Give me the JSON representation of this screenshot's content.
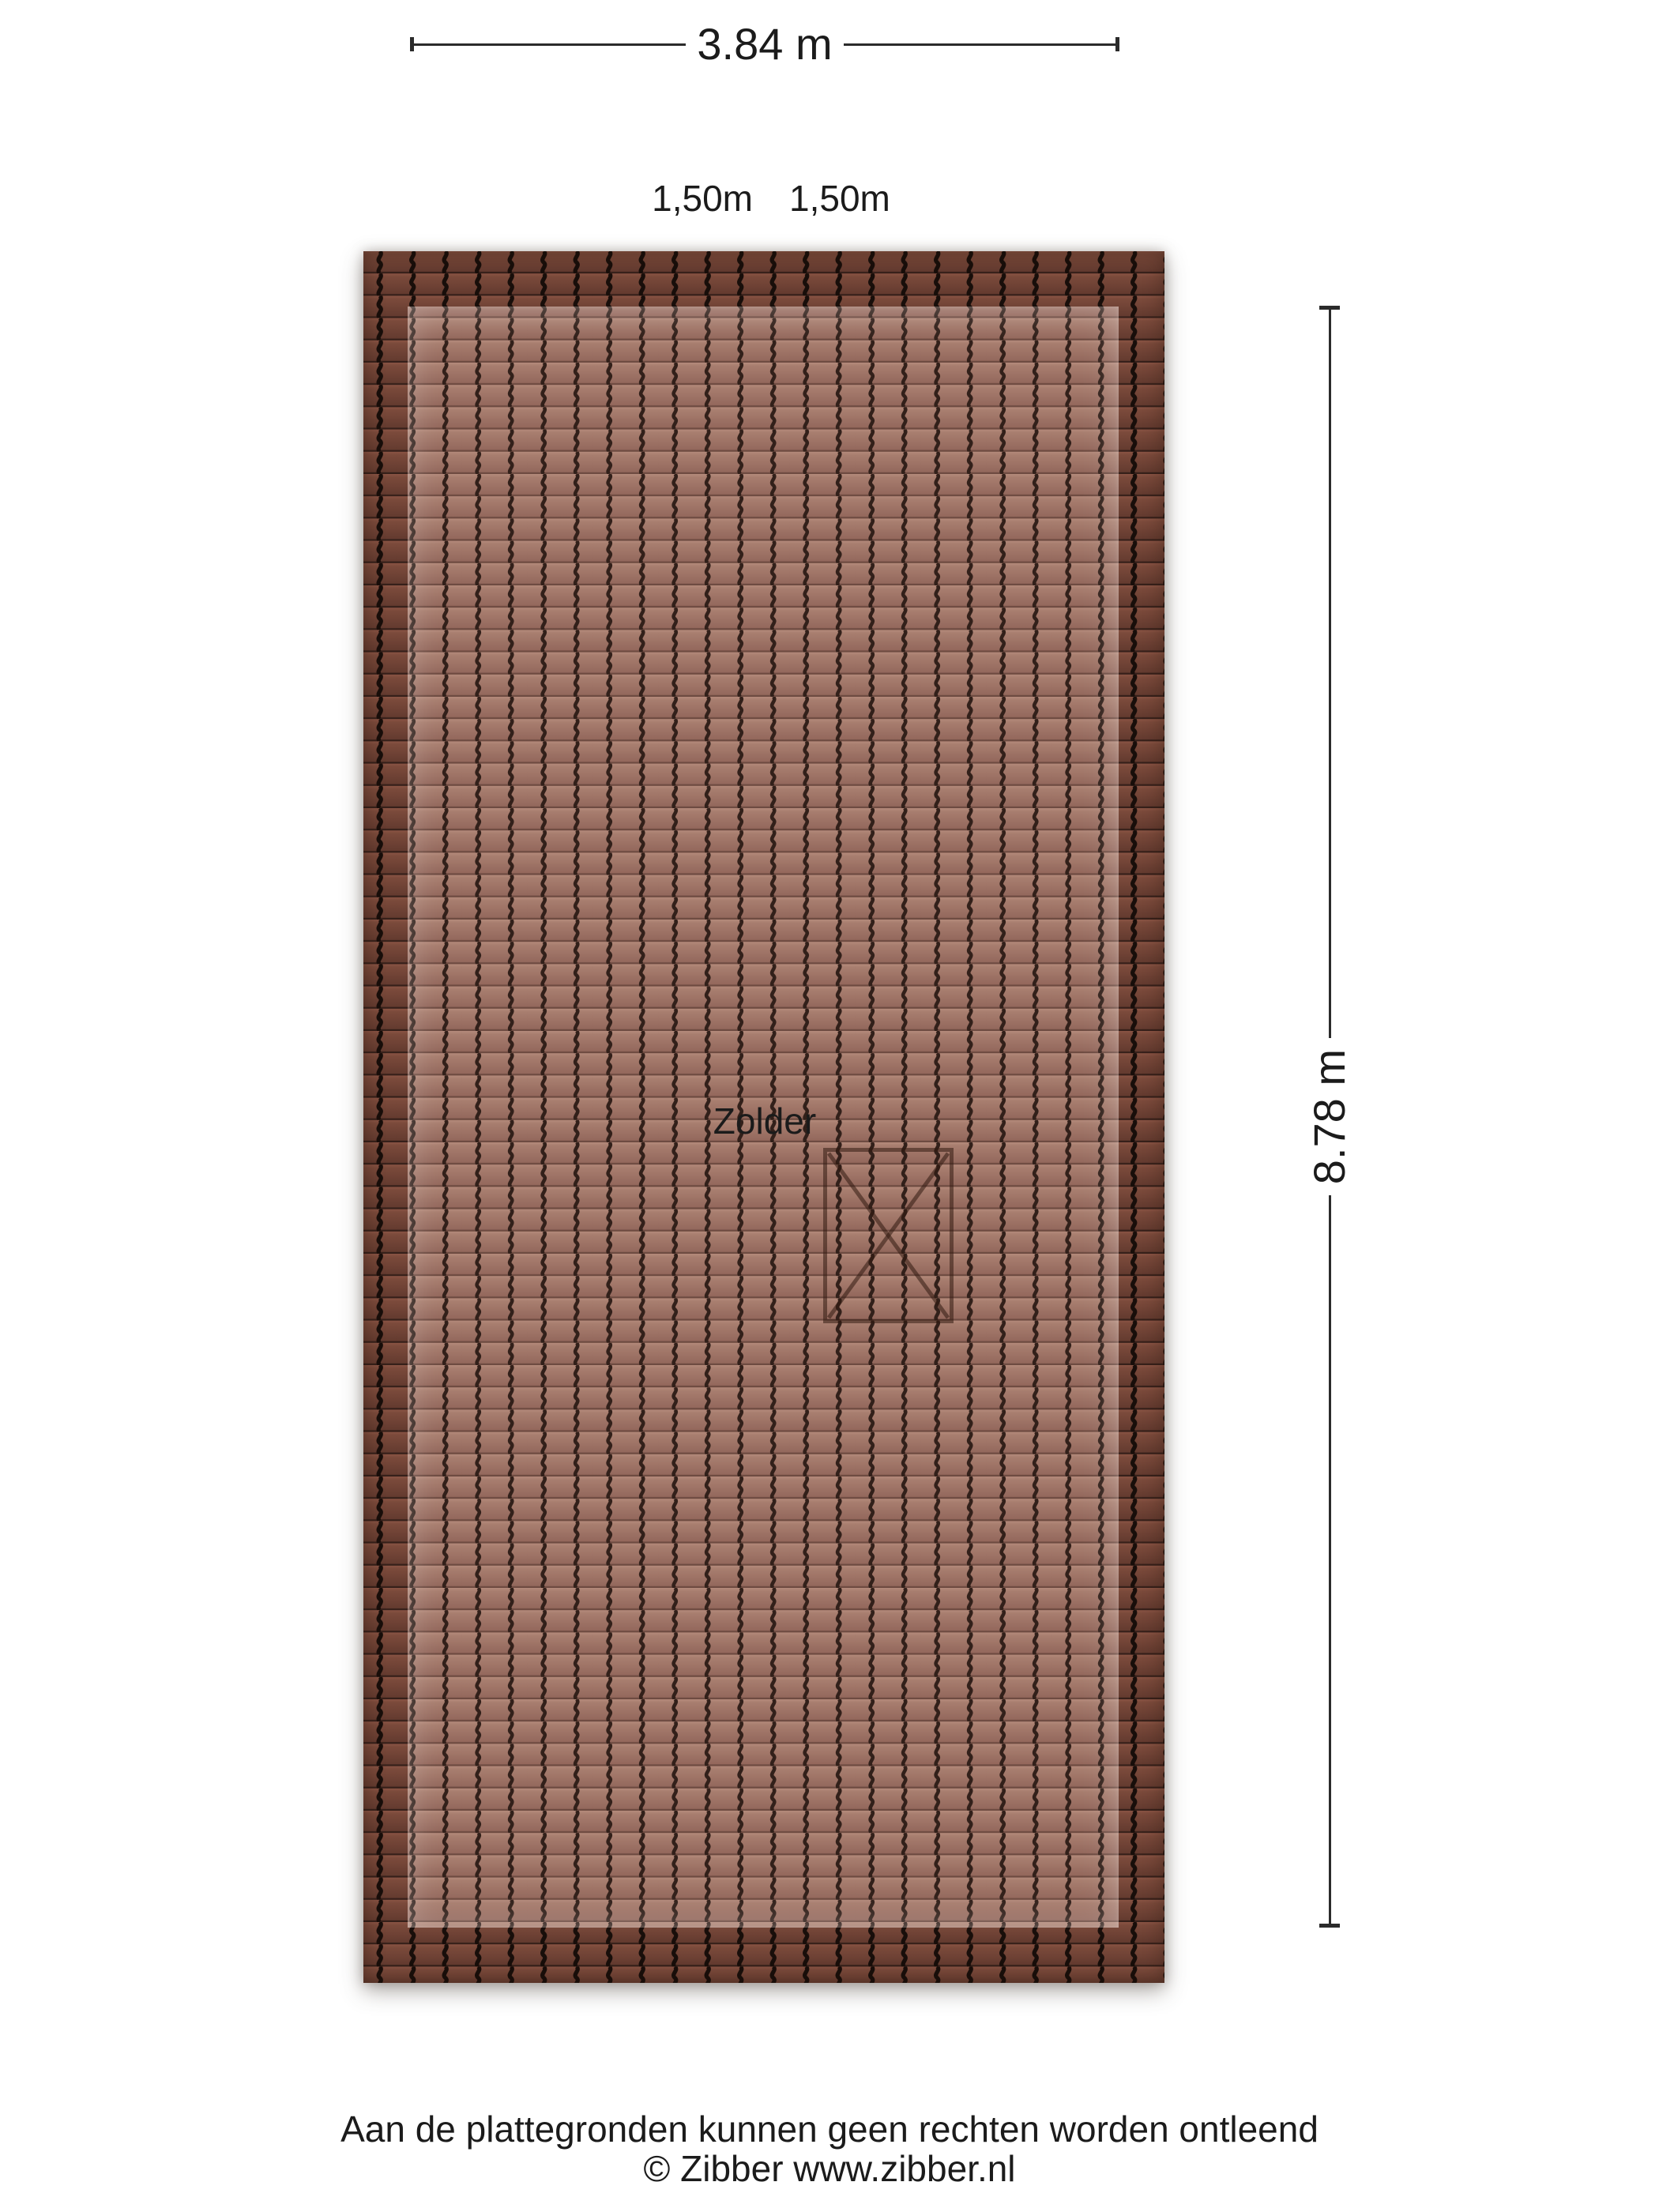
{
  "dimensions": {
    "width_label": "3.84 m",
    "slope_left_label": "1,50m",
    "slope_right_label": "1,50m",
    "height_label": "8.78 m"
  },
  "room": {
    "label": "Zolder"
  },
  "icons": {
    "stair_opening": "x-cross-box",
    "dimension_end": "tick-bar"
  },
  "footer": {
    "disclaimer": "Aan de plattegronden kunnen geen rechten worden ontleend",
    "copyright": "© Zibber www.zibber.nl"
  },
  "colors": {
    "dim_line": "#2b2b2b",
    "text_color": "#1b1b1b",
    "tile_inner_hi": "#b48a7b",
    "tile_inner_top": "#a87e6f",
    "tile_inner_bottom": "#91655a",
    "tile_inner_sep": "#6e4b41",
    "tile_inner_wave": "#32201a",
    "tile_border_hi": "#8a5444",
    "tile_border_top": "#7b4a3b",
    "tile_border_bottom": "#61392e",
    "tile_border_sep": "#36201a",
    "tile_border_wave": "#180e0a",
    "stair_line": "rgba(50,26,16,0.55)"
  }
}
